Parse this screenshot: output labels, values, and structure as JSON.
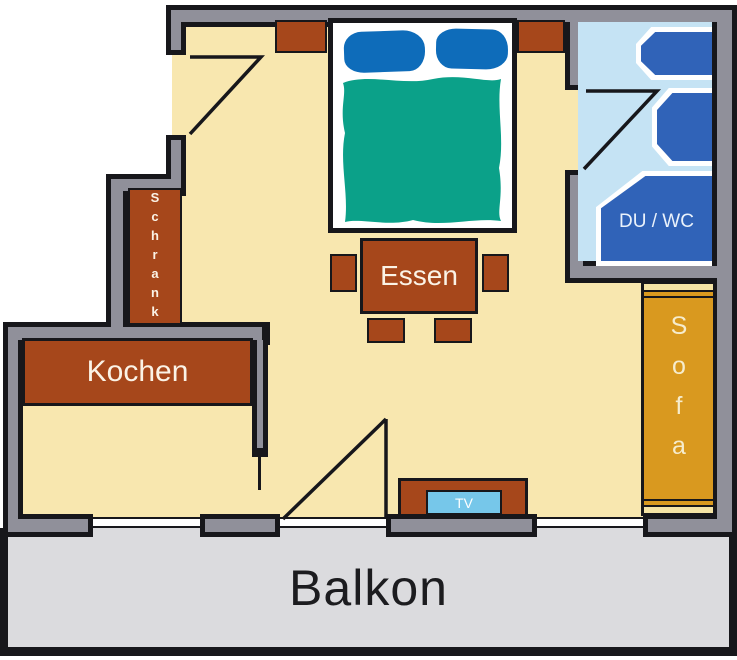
{
  "labels": {
    "balcony": "Balkon",
    "kitchen": "Kochen",
    "dining": "Essen",
    "wardrobe": "Schrank",
    "sofa": "Sofa",
    "tv": "TV",
    "bathroom": "DU / WC"
  },
  "colors": {
    "floor": "#F8E7AF",
    "wall": "#90909A",
    "outline": "#17171B",
    "balcony": "#DBDBDE",
    "balconyText": "#1C1C1F",
    "furniture": "#A6471B",
    "label": "#FBF3E6",
    "bedBase": "#FFFFFF",
    "pillow": "#0E6CBA",
    "blanket": "#0BA189",
    "bathFloor": "#C5E3F4",
    "bathFixture": "#3063B8",
    "fixtureOutline": "#FFFFFF",
    "sofa": "#D9991F",
    "sofaTrim": "#F5E4A5",
    "tvScreen": "#76C7EA"
  }
}
